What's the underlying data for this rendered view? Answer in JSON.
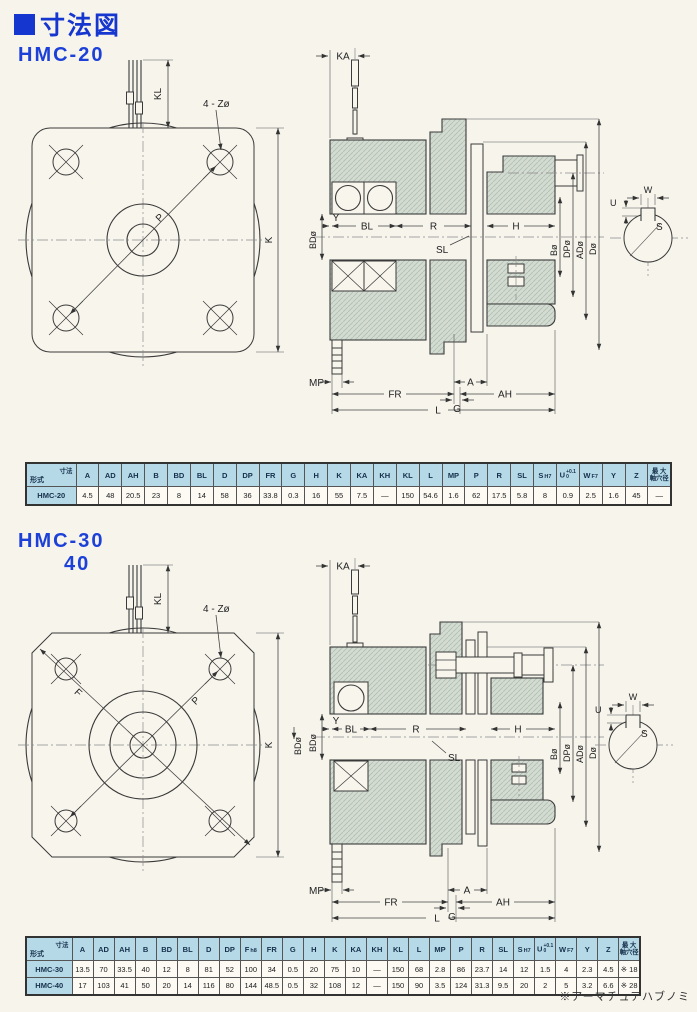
{
  "page": {
    "title": "寸法図",
    "footnote": "※アーマチュアハブノミ"
  },
  "sections": [
    {
      "model": "HMC-20",
      "model2": ""
    },
    {
      "model": "HMC-30",
      "model2": "40"
    }
  ],
  "corner": {
    "top": "寸法",
    "bottom": "形式"
  },
  "labels": {
    "kl": "KL",
    "zholes": "4 - Zø",
    "p": "P",
    "k": "K",
    "f": "F",
    "ka": "KA",
    "bd": "BDø",
    "y": "Y",
    "bl": "BL",
    "r": "R",
    "sl": "SL",
    "h": "H",
    "b": "Bø",
    "dp": "DPø",
    "ad": "ADø",
    "d": "Dø",
    "mp": "MP",
    "fr": "FR",
    "a": "A",
    "g": "G",
    "ah": "AH",
    "l": "L",
    "w": "W",
    "u": "U",
    "s": "S"
  },
  "colors": {
    "accent_blue": "#1636d0",
    "table_header": "#b5d9e6",
    "drawing_fill": "#d3dbd2",
    "page_background": "#f7f4ec"
  },
  "tables": [
    {
      "columns": [
        {
          "l": "A"
        },
        {
          "l": "AD"
        },
        {
          "l": "AH"
        },
        {
          "l": "B"
        },
        {
          "l": "BD"
        },
        {
          "l": "BL"
        },
        {
          "l": "D"
        },
        {
          "l": "DP"
        },
        {
          "l": "FR"
        },
        {
          "l": "G"
        },
        {
          "l": "H"
        },
        {
          "l": "K"
        },
        {
          "l": "KA"
        },
        {
          "l": "KH"
        },
        {
          "l": "KL"
        },
        {
          "l": "L"
        },
        {
          "l": "MP"
        },
        {
          "l": "P"
        },
        {
          "l": "R"
        },
        {
          "l": "SL"
        },
        {
          "l": "S",
          "s": "H7"
        },
        {
          "l": "U",
          "tt": "+0.1",
          "tb": "0"
        },
        {
          "l": "W",
          "s": "F7"
        },
        {
          "l": "Y"
        },
        {
          "l": "Z"
        },
        {
          "l2": [
            "最 大",
            "軸穴径"
          ]
        }
      ],
      "rows": [
        {
          "model": "HMC-20",
          "values": [
            "4.5",
            "48",
            "20.5",
            "23",
            "8",
            "14",
            "58",
            "36",
            "33.8",
            "0.3",
            "16",
            "55",
            "7.5",
            "—",
            "150",
            "54.6",
            "1.6",
            "62",
            "17.5",
            "5.8",
            "8",
            "0.9",
            "2.5",
            "1.6",
            "45",
            "—"
          ]
        }
      ]
    },
    {
      "columns": [
        {
          "l": "A"
        },
        {
          "l": "AD"
        },
        {
          "l": "AH"
        },
        {
          "l": "B"
        },
        {
          "l": "BD"
        },
        {
          "l": "BL"
        },
        {
          "l": "D"
        },
        {
          "l": "DP"
        },
        {
          "l": "F",
          "s": "h8"
        },
        {
          "l": "FR"
        },
        {
          "l": "G"
        },
        {
          "l": "H"
        },
        {
          "l": "K"
        },
        {
          "l": "KA"
        },
        {
          "l": "KH"
        },
        {
          "l": "KL"
        },
        {
          "l": "L"
        },
        {
          "l": "MP"
        },
        {
          "l": "P"
        },
        {
          "l": "R"
        },
        {
          "l": "SL"
        },
        {
          "l": "S",
          "s": "H7"
        },
        {
          "l": "U",
          "tt": "+0.1",
          "tb": "0"
        },
        {
          "l": "W",
          "s": "F7"
        },
        {
          "l": "Y"
        },
        {
          "l": "Z"
        },
        {
          "l2": [
            "最 大",
            "軸穴径"
          ]
        }
      ],
      "rows": [
        {
          "model": "HMC-30",
          "values": [
            "13.5",
            "70",
            "33.5",
            "40",
            "12",
            "8",
            "81",
            "52",
            "100",
            "34",
            "0.5",
            "20",
            "75",
            "10",
            "—",
            "150",
            "68",
            "2.8",
            "86",
            "23.7",
            "14",
            "12",
            "1.5",
            "4",
            "2.3",
            "4.5",
            "※ 18"
          ]
        },
        {
          "model": "HMC-40",
          "values": [
            "17",
            "103",
            "41",
            "50",
            "20",
            "14",
            "116",
            "80",
            "144",
            "48.5",
            "0.5",
            "32",
            "108",
            "12",
            "—",
            "150",
            "90",
            "3.5",
            "124",
            "31.3",
            "9.5",
            "20",
            "2",
            "5",
            "3.2",
            "6.6",
            "※ 28"
          ]
        }
      ]
    }
  ]
}
